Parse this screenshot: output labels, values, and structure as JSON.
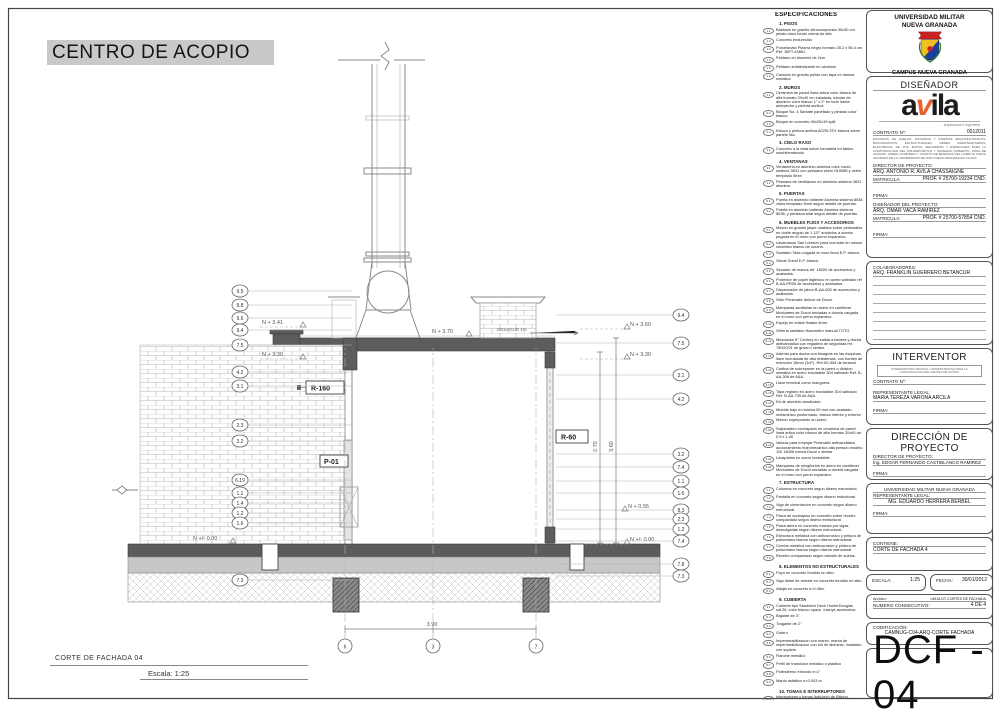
{
  "sheet": {
    "project_title": "CENTRO DE ACOPIO",
    "drawing_title": "CORTE DE FACHADA 04",
    "scale_label": "Escala: 1:25"
  },
  "drawing": {
    "levels": {
      "left_upper": "N + 3.41",
      "left_mid": "N + 3.30",
      "left_zero": "N +/- 0.00",
      "roof": "N + 3.70",
      "right_upper": "N + 3.60",
      "right_mid": "N + 3.30",
      "right_low": "N + 0.55",
      "right_zero": "N +/- 0.00"
    },
    "labels": {
      "r160": "R-160",
      "r60": "R-60",
      "p01": "P-01",
      "desague": "DESAGUE 1%"
    },
    "dims": {
      "right_inner": "2.70",
      "right_outer": "3.60",
      "bottom": "3.90"
    },
    "left_callouts": [
      "9.5",
      "9.8",
      "9.6",
      "9.4",
      "7.5",
      "4.2",
      "3.1",
      "2.3",
      "3.2",
      "6.19",
      "1.1",
      "1.4",
      "1.2",
      "1.6",
      "7.3"
    ],
    "right_callouts": [
      "9.4",
      "7.5",
      "3.1",
      "4.2",
      "3.2",
      "7.4",
      "1.1",
      "1.6",
      "8.3",
      "2.3",
      "1.2",
      "7.4",
      "7.8",
      "7.3"
    ],
    "grid_bubbles": [
      "6",
      "3",
      "7"
    ]
  },
  "specs": {
    "title": "ESPECIFICACIONES",
    "sections": [
      {
        "heading": "1. PISOS",
        "items": [
          {
            "n": "1.1",
            "t": "Baldosin en granito vitrocompuesto 30x30 cm pelato claro fondo crema de alfa"
          },
          {
            "n": "1.2",
            "t": "Concreto endurecido"
          },
          {
            "n": "1.3",
            "t": "Porcelanato Pizarra negro formato 28.2 x 56.4 cm Ref. 36FT-43661"
          },
          {
            "n": "1.4",
            "t": "Peldano en aluminio de 2cm"
          },
          {
            "n": "1.5",
            "t": "Peldano antideslizante en aluminio"
          },
          {
            "n": "1.6",
            "t": "Canuela en granito pulido con tapa en lamina metalica"
          }
        ]
      },
      {
        "heading": "2. MUROS",
        "items": [
          {
            "n": "2.1",
            "t": "Ceramica de pared linea artica color blanco de alfa formato 20x40 cm instalada, tubular de aluminio color blanco 1\" x 2\" en todo hasta antepecho y pintura acrilica"
          },
          {
            "n": "2.2",
            "t": "Bloque No. 4 Santafe panetado y pintado color blanco."
          },
          {
            "n": "2.3",
            "t": "Bloque en concreto 40x20x15 split"
          },
          {
            "n": "2.4",
            "t": "Estuco y pintura acrilica ACRILTEX blanca sobre panete liso"
          }
        ]
      },
      {
        "heading": "3. CIELO RASO",
        "items": [
          {
            "n": "3.1",
            "t": "Concreto a la vista sobre formaleta en tablon machihembrado"
          }
        ]
      },
      {
        "heading": "4. VENTANAS",
        "items": [
          {
            "n": "4.1",
            "t": "Ventaneria en aluminio alumina color crudo sistema 3831 con persiana vidrio HL5085 y vidrio templado 5mm"
          },
          {
            "n": "4.2",
            "t": "Persiana de ventilacion en aluminio sistema 3831 alumina."
          }
        ]
      },
      {
        "heading": "5. PUERTAS",
        "items": [
          {
            "n": "5.1",
            "t": "Puerta en aluminio batiente Alumina sistema 8038 vidrio templado 5mm segun detalle de puertas."
          },
          {
            "n": "5.2",
            "t": "Puerta en aluminio batiente Alumina sistema 8038, y persiana total segun detalle de puertas."
          }
        ]
      },
      {
        "heading": "6. MUEBLES FIJOS Y ACCESORIOS",
        "items": [
          {
            "n": "6.1",
            "t": "Meson en granito jaspe ubatuba sobre pedestales en doble angulo de 1 1/2\" anclados a dovela pegada en el muro con perno expansivo."
          },
          {
            "n": "6.2",
            "t": "Lavamanos San Lorenzo para incrustar en meson ceramico blanco de corona."
          },
          {
            "n": "6.3",
            "t": "Sanitario Tasa colgada al muro linea E.P. blanco."
          },
          {
            "n": "6.4",
            "t": "Orinal Grival E.P. blanco."
          },
          {
            "n": "6.5",
            "t": "Secador de manos ref. 18200 de accesorios y acabados."
          },
          {
            "n": "6.6",
            "t": "Protector de papel higienico en acero satinado ref B-AA-PR05 de accesorios y acabados."
          },
          {
            "n": "6.7",
            "t": "Dispensador de jabon B-AA-500 de accesorios y acabados."
          },
          {
            "n": "6.8",
            "t": "Grifo Presmatic deluxe de Docol."
          },
          {
            "n": "6.9",
            "t": "Mamparas sanitarias en acero en cantilever Modulares de Docol ancladas a dovela cargada en el muro con perno expansivo."
          },
          {
            "n": "6.10",
            "t": "Espejo en cristal flotado 6mm."
          },
          {
            "n": "6.11",
            "t": "Griferia sanitario fluxometro manual TOTO."
          },
          {
            "n": "6.12",
            "t": "Mezclador 8\" Century en salida a banera y ducha antivandalica con regadera de seguridad ref. 75H2O01 de grival o similar."
          },
          {
            "n": "6.13",
            "t": "Asiento para ducha con bisagras en las esquinas, llave incrustada de alta resistencia, con bordes de retencion 18mm (3/4\"). Ref AS-554 de bruseal"
          },
          {
            "n": "6.14",
            "t": "Cortina de sobreponer en la pared o division metalica en acero inoxidable 304 satinado Ref. B-AA-306 de A&A."
          },
          {
            "n": "6.15",
            "t": "Llave terminal como manguera."
          },
          {
            "n": "6.16",
            "t": "Tapa registro en acero inoxidable 304 satinado Ref. B-AA-705 de A&A."
          },
          {
            "n": "6.17",
            "t": "Kit de aluminio anodizado"
          },
          {
            "n": "6.18",
            "t": "Mueble bajo en lamina 50 mm con acabado melaminico posformado, blanco interior y exterior"
          },
          {
            "n": "6.19",
            "t": "Meson superpuesto en acero"
          },
          {
            "n": "6.20",
            "t": "Salpicadero enchapado en ceramica de pared linea artica color blanco de alfa formato 20x40 de 0.9 x 1.40"
          },
          {
            "n": "6.21",
            "t": "Valvula para empujar Presmatic antivandalica accionamiento hidromecanico alta presion modelo 110 16006 marca Docol o similar"
          },
          {
            "n": "6.22",
            "t": "Lavaplatos en acero inoxidable"
          },
          {
            "n": "6.23",
            "t": "Mamparas de mingitorios en acero en cantilever Modulares de Docol ancladas a dovela cargada en el muro con perno expansivo"
          }
        ]
      },
      {
        "heading": "7. ESTRUCTURA",
        "items": [
          {
            "n": "7.1",
            "t": "Columna en concreto segun diseno estructural."
          },
          {
            "n": "7.2",
            "t": "Pantalla en concreto segun diseno estructural."
          },
          {
            "n": "7.3",
            "t": "Viga de cimentacion en concreto segun diseno estructural."
          },
          {
            "n": "7.4",
            "t": "Placa de contrapiso en concreto sobre recebo compactado segun diseno estructural."
          },
          {
            "n": "7.5",
            "t": "Placa aerea en concreto maciza por vigas descolgadas segun diseno estructural."
          },
          {
            "n": "7.6",
            "t": "Estructura metalica con anticorrosivo y pintura de poliuretano blanca segun diseno estructural."
          },
          {
            "n": "7.7",
            "t": "Cercha metalica con anticorrosivo y pintura de poliuretano blanca segun diseno estructural"
          },
          {
            "n": "7.8",
            "t": "Recebo compactado segun estudio de suelos."
          }
        ]
      },
      {
        "heading": "8. ELEMENTOS NO ESTRUCTURALES",
        "items": [
          {
            "n": "8.1",
            "t": "Poyo en concreto fundido en sitio."
          },
          {
            "n": "8.2",
            "t": "Viga dintel de remate en concreto fundido en sitio."
          },
          {
            "n": "8.3",
            "t": "Alfajia en concreto e=0.08m"
          }
        ]
      },
      {
        "heading": "9. CUBIERTA",
        "items": [
          {
            "n": "9.1",
            "t": "Cubierta tipo Sandwich Deck HunterDouglas cal.26, color blanco opaco. Incluye accesorios."
          },
          {
            "n": "9.2",
            "t": "Bajante de 3\"."
          },
          {
            "n": "9.3",
            "t": "Tragante de 2\"."
          },
          {
            "n": "9.4",
            "t": "Gotero"
          },
          {
            "n": "9.5",
            "t": "Impermeabilizacion con manto, manta de impermeabilizacion con foil de aluminio, instalado con soplete."
          },
          {
            "n": "9.6",
            "t": "Flanche metalico"
          },
          {
            "n": "9.7",
            "t": "Perfil de transicion metalico o plastico"
          },
          {
            "n": "9.8",
            "t": "Poliestireno extruido e=1\""
          },
          {
            "n": "9.9",
            "t": "Manto asfaltico e=0.003 m"
          }
        ]
      },
      {
        "heading": "10. TOMAS E INTERRUPTORES",
        "items": [
          {
            "n": "10.1",
            "t": "Interruptores y tomas light-tech de Bticino."
          },
          {
            "n": "10.2",
            "t": "Tomas GFCI de Bticino."
          }
        ]
      },
      {
        "heading": "11. OTROS",
        "items": [
          {
            "n": "11.1",
            "t": "Cerramiento en malla eslabonada galvanizada 2\" calibre 10, h= 2.40 m (verticales angulo de 2\" y 3\", tensores de 2\" y pintura anticorrosiva y esmalte tipo 1)"
          },
          {
            "n": "11.2",
            "t": "Tanque de agua de 2.000 Litros"
          }
        ]
      }
    ]
  },
  "titleblock": {
    "university": {
      "name_line1": "UNIVERSIDAD MILITAR",
      "name_line2": "NUEVA GRANADA",
      "campus": "CAMPUS NUEVA GRANADA"
    },
    "designer": {
      "header": "DISEÑADOR",
      "logo": {
        "p1": "a",
        "p2": "v",
        "p3": "ila",
        "caption": "arquitectura e ingenieria"
      },
      "contract_label": "CONTRATO Nº:",
      "contract_value": "0012011",
      "fine_print": "ESTUDIOS DE SUELOS, ESTUDIOS Y DISEÑOS ARQUITECTONICOS, BIOCLIMATICOS, ESTRUCTURALES, REDES HIDROSANITARIAS, ELECTRICAS, DE VOZ, DATOS, SEGURIDAD Y ESPECIALES PARA LA CONSTRUCCION DEL POLIDEPORTIVO Y GIMNASIO CUBIERTO, ZONA DE ACCESO, ANDEN, PORTERIA Y CUARTO DE BASURAS DEL CAMPUS NUEVA GRANADA DE LA UNIVERSIDAD MILITAR NUEVA GRANADA EN CAJICA",
      "director_label": "DIRECTOR DE PROYECTO:",
      "director_name": "ARQ. ANTONIO R. AVILA CHASSAIGNE",
      "matricula_label": "MATRICULA:",
      "director_matricula": "PROF. # 25700-19234 CND.",
      "firma_label": "FIRMA:",
      "designer_label": "DISEÑADOR DEL PROYECTO:",
      "designer_name": "ARQ. OMAR VACA RAMIREZ",
      "designer_matricula": "PROF. # 25700-57854 CND."
    },
    "collaborators": {
      "label": "COLABORADORES:",
      "name": "ARQ. FRANKLIN GUERRERO BETANCUR"
    },
    "interventor": {
      "header": "INTERVENTOR",
      "note": "INTERVENTORIA TECNICA Y ADMINISTRATIVA PARA LA CONSTRUCCION DEL CENTRO DE ACOPIO",
      "contract_label": "CONTRATO Nº:",
      "rep_label": "REPRESENTANTE LEGAL:",
      "rep_name": "MARIA TEREZA VARONA ARCILA",
      "firma_label": "FIRMA:"
    },
    "direccion": {
      "header": "DIRECCIÓN DE PROYECTO",
      "director_label": "DIRECTOR DE PROYECTO:",
      "director_name": "Ing. EDGAR FERNANDO CASTIBLANCO RAMÍREZ",
      "firma_label": "FIRMA:"
    },
    "umng_legal": {
      "name": "UNIVERSIDAD MILITAR NUEVA GRANADA",
      "rep_label": "REPRESENTANTE LEGAL:",
      "rep_name": "MG. EDUARDO HERRERA BERBEL",
      "firma_label": "FIRMA:"
    },
    "contiene": {
      "label": "CONTIENE:",
      "value": "CORTE DE FACHADA 4"
    },
    "escala": {
      "label": "ESCALA:",
      "value": "1:25"
    },
    "fecha": {
      "label": "FECHA:",
      "value": "30/01/2012"
    },
    "archivo": {
      "label": "Archivo:",
      "value": "UM-M-DT-CORTES DE FACHADA",
      "consec_label": "NUMERO CONSECUTIVO:",
      "consec_value": "4 DE 4"
    },
    "codificacion": {
      "label": "CODIFICACIÓN:",
      "value": "CAMNUG-C04-ARQ-CORTE FACHADA"
    },
    "sheet_code": "DCF - 04"
  },
  "colors": {
    "accent_orange": "#e8622d",
    "crest_red": "#c92222",
    "crest_yellow": "#f0c020",
    "crest_blue": "#1a3fa0",
    "crest_green": "#2e7d32",
    "title_highlight": "#c9c9c9"
  }
}
